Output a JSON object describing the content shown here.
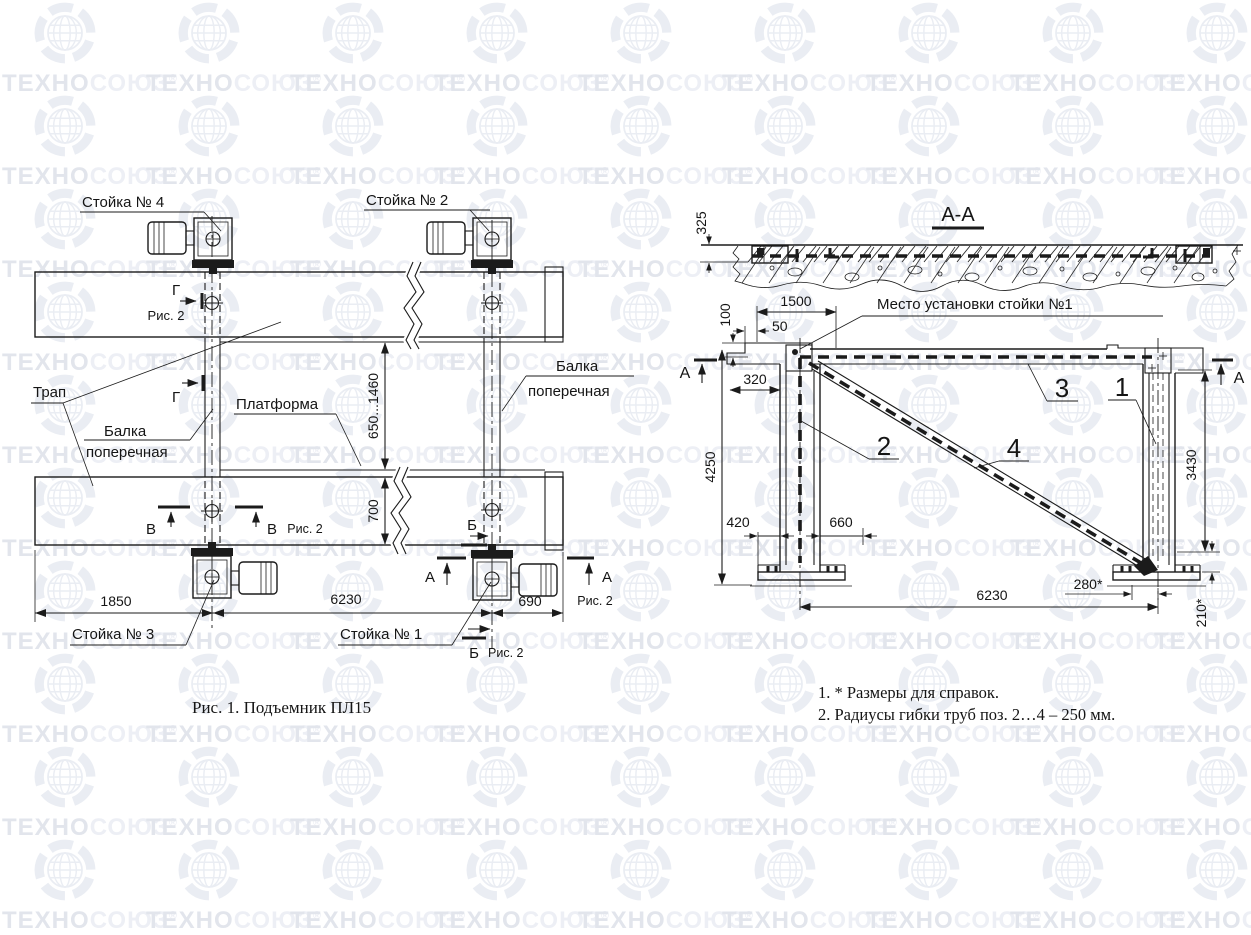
{
  "watermark": {
    "brand_part1": "ТЕХНО",
    "brand_part2": "СОЮЗ",
    "registered_mark": "®",
    "color_dark": "#e2e5ec",
    "color_light": "#edeff5",
    "globe_color": "#eaedf3"
  },
  "fig1": {
    "caption": "Рис. 1. Подъемник ПЛ15",
    "labels": {
      "stand4": "Стойка № 4",
      "stand2": "Стойка № 2",
      "stand3": "Стойка № 3",
      "stand1": "Стойка № 1",
      "ramp": "Трап",
      "cross_beam_word1": "Балка",
      "cross_beam_word2": "поперечная",
      "platform": "Платформа"
    },
    "sections": {
      "g": "Г",
      "v": "В",
      "b": "Б",
      "a": "А",
      "ref": "Рис. 2"
    },
    "dims": {
      "platform_gap": "650...1460",
      "ramp_width": "700",
      "left_span": "1850",
      "center_span": "6230",
      "right_span": "690"
    }
  },
  "fig2": {
    "title": "А-А",
    "install_note": "Место установки стойки №1",
    "positions": [
      "1",
      "2",
      "3",
      "4"
    ],
    "section_letter": "А",
    "dims": {
      "d325": "325",
      "d1500": "1500",
      "d100": "100",
      "d50": "50",
      "d320": "320",
      "d4250": "4250",
      "d420": "420",
      "d660": "660",
      "d6230": "6230",
      "d280": "280*",
      "d210": "210*",
      "d3430": "3430"
    }
  },
  "notes": {
    "line1": "1. * Размеры для справок.",
    "line2": "2. Радиусы гибки труб поз. 2…4 – 250 мм."
  }
}
